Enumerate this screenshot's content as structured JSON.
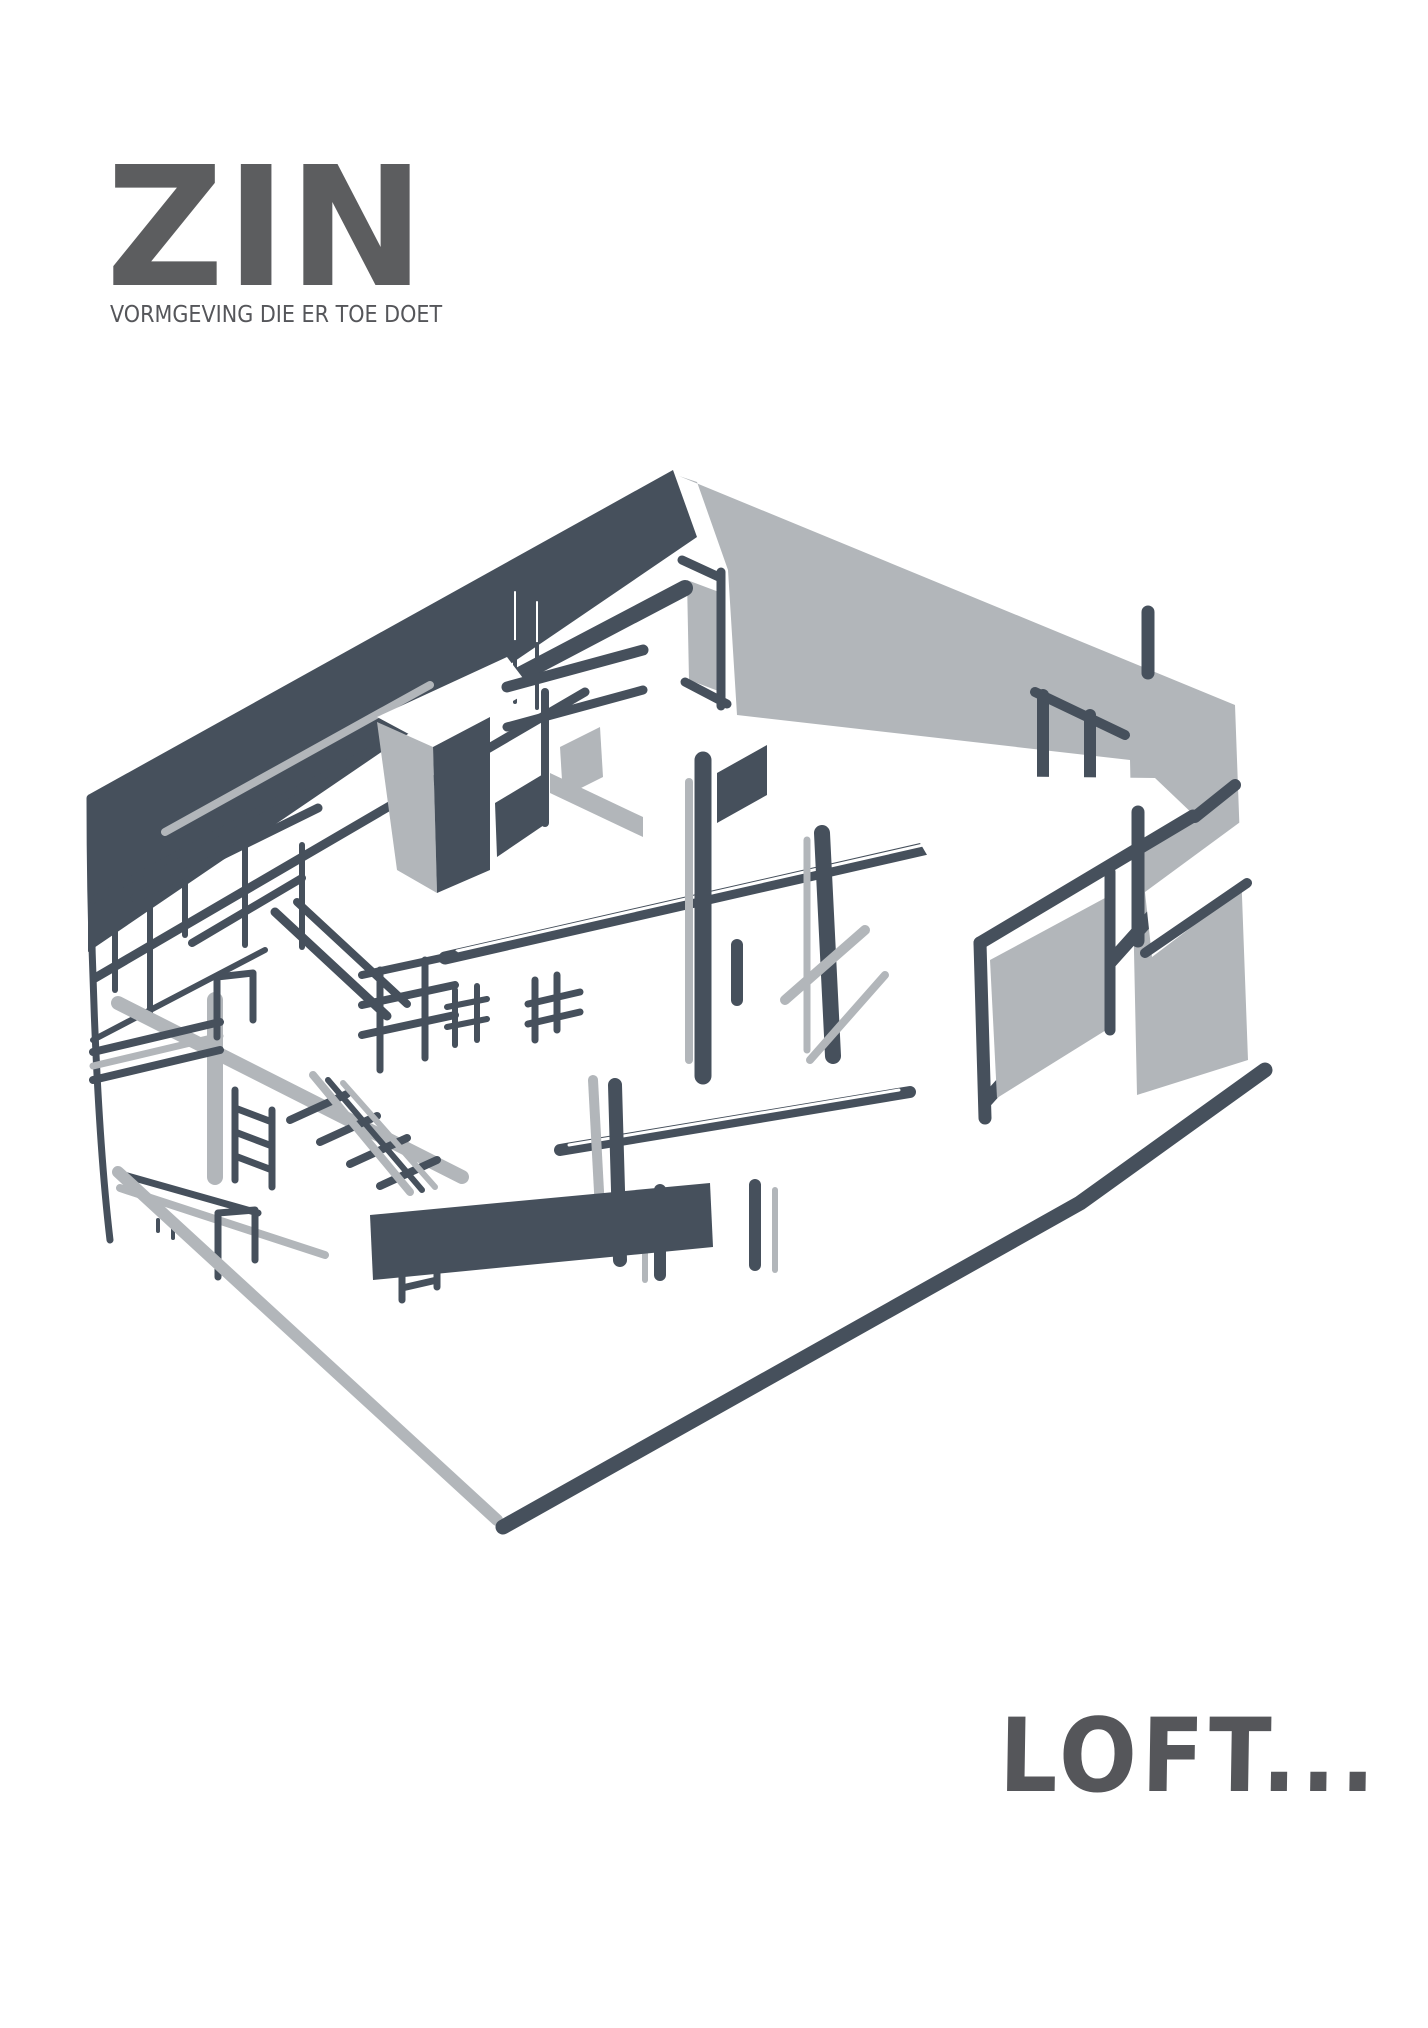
{
  "brand": {
    "logo": "ZIN",
    "tagline": "VORMGEVING DIE ER TOE DOET"
  },
  "artwork": {
    "subject": "loft interior axonometric sketch",
    "description": "Hand-drawn cutaway axonometric sketch of a double-height loft interior with a mezzanine deck, staircases, ladders, slender columns, railings and built-in furniture, drawn in dark slate and light grey marker",
    "ink_color": "#46505C",
    "mist_color": "#B2B6BA"
  },
  "footer": {
    "wordmark": "LOFT..."
  },
  "colors": {
    "background": "#FFFFFF",
    "logo_gray": "#5C5D5F",
    "text_gray": "#55565A"
  }
}
